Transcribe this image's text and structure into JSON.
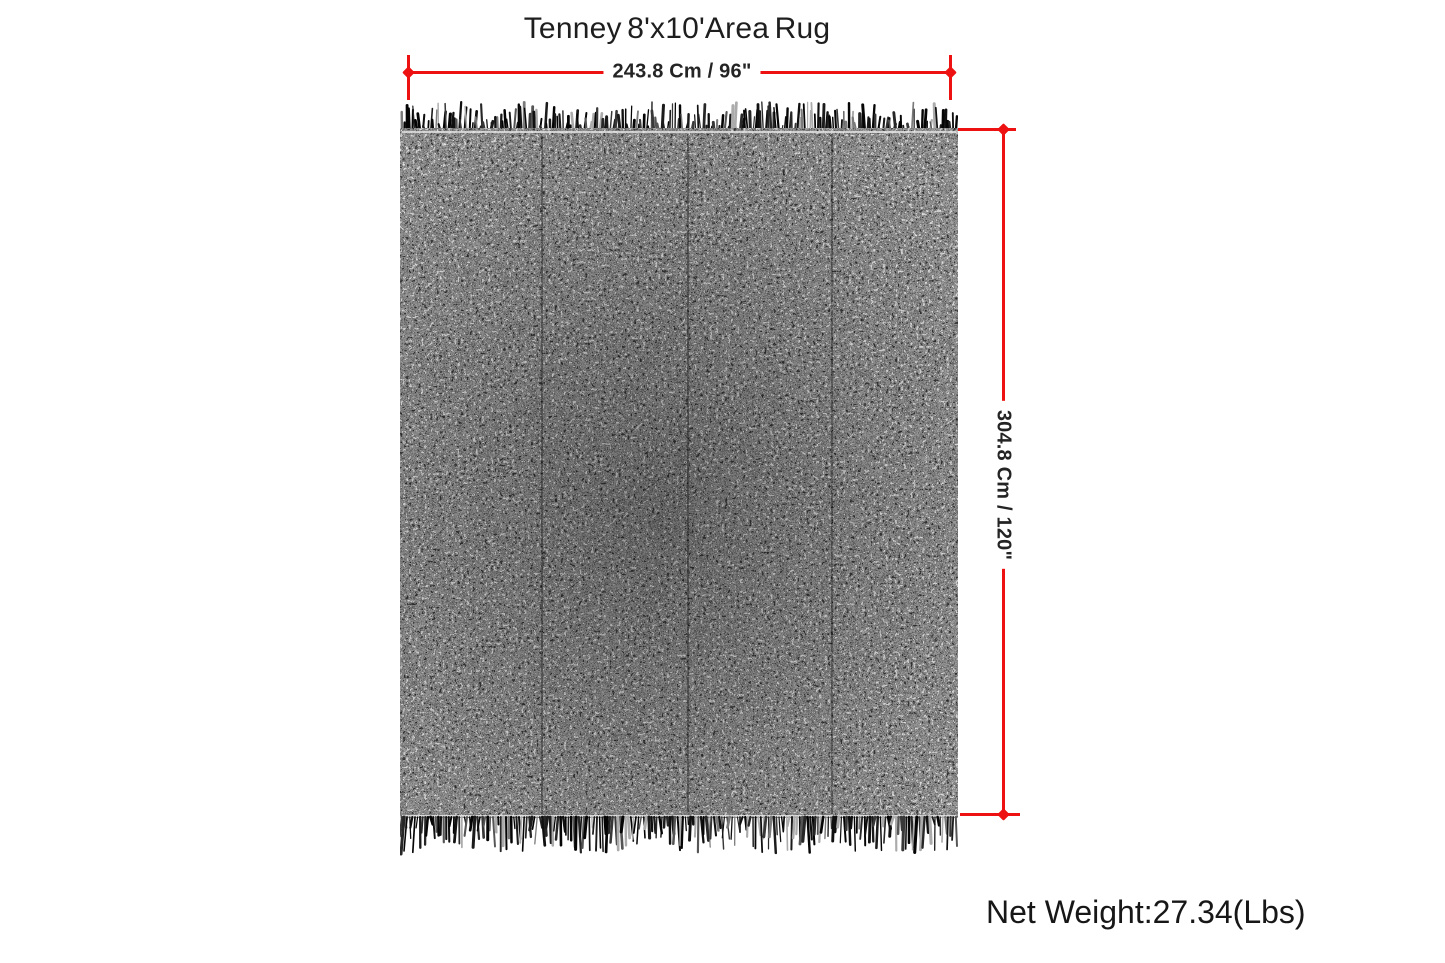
{
  "product": {
    "title": "Tenney 8'x10'Area Rug",
    "net_weight": "Net Weight:27.34(Lbs)"
  },
  "dimensions": {
    "width": {
      "label": "243.8 Cm / 96\""
    },
    "height": {
      "label": "304.8 Cm / 120\""
    }
  },
  "colors": {
    "dimension_accent": "#ee1111",
    "rug_base": "#1c1c1c",
    "rug_speckle": "#b5b5b5",
    "text": "#1e1e1e"
  }
}
